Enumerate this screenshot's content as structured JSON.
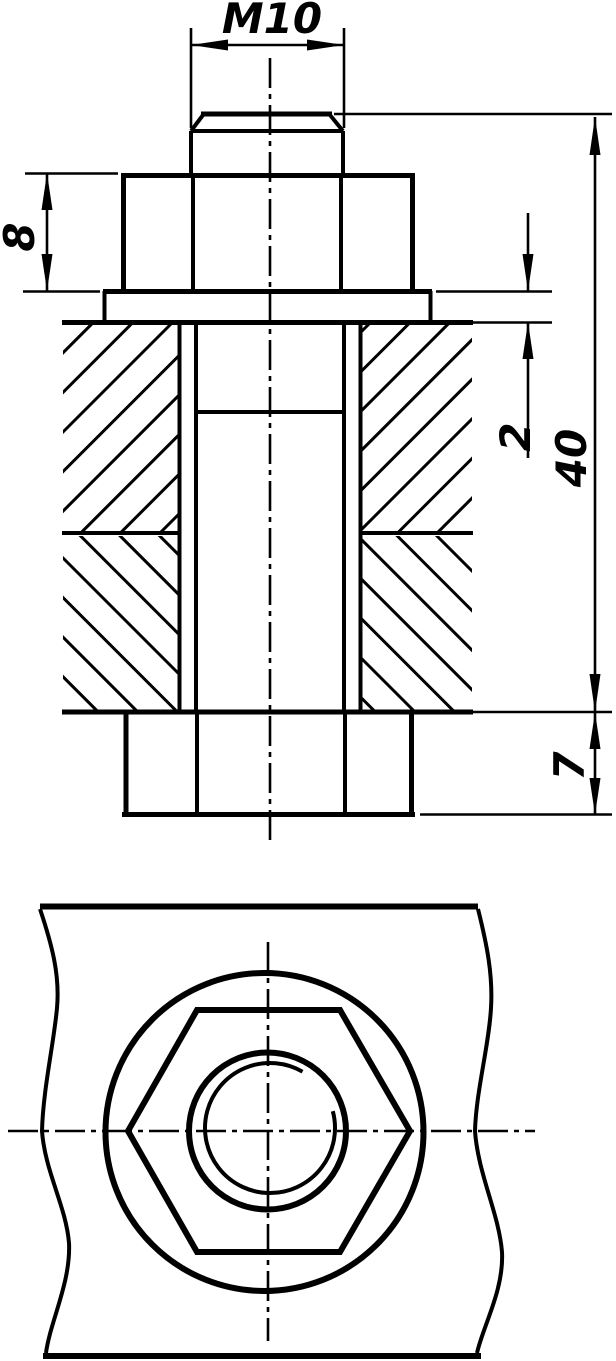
{
  "drawing": {
    "title": "Bolted joint assembly drawing",
    "colors": {
      "line": "#000000",
      "background": "#ffffff"
    },
    "views": {
      "section": {
        "label": "front sectional view of bolt, nut and washer clamping two plates"
      },
      "plan": {
        "label": "top view of nut and washer on plate"
      }
    },
    "dimensions": {
      "thread": "M10",
      "nut_height": "8",
      "washer_thickness": "2",
      "bolt_length": "40",
      "head_height": "7"
    }
  }
}
